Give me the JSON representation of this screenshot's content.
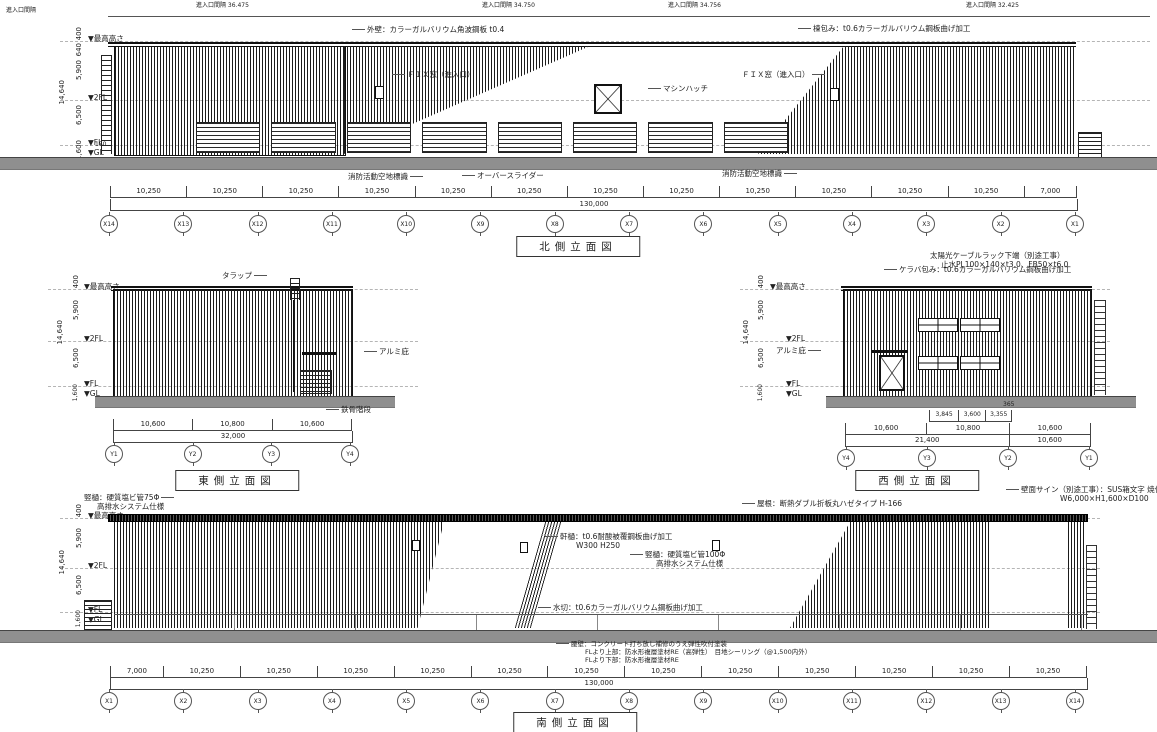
{
  "levels": {
    "names": [
      "▼最高高さ",
      "▼2FL",
      "▼FL",
      "▼GL"
    ],
    "vdims": [
      "400",
      "640",
      "5,900",
      "6,500",
      "1,600"
    ],
    "offset_fl": "150",
    "total": "14,640"
  },
  "north": {
    "title": "北側立面図",
    "entry_label": "進入口間隔",
    "top_dims": [
      "進入口間隔 36.475",
      "進入口間隔 34.750",
      "進入口間隔 34.756",
      "進入口間隔 32.425"
    ],
    "ann": {
      "wall": "外壁：カラーガルバリウム角波鋼板 t0.4",
      "ridge": "棟包み：t0.6カラーガルバリウム鋼板曲げ加工",
      "fix_left": "ＦＩＸ窓（進入口）",
      "fix_right": "ＦＩＸ窓（進入口）",
      "machine_hatch": "マシンハッチ",
      "fire_sign_left": "消防活動空地標識",
      "fire_sign_right": "消防活動空地標識",
      "overhead_slider": "オーバースライダー"
    },
    "dims": [
      {
        "label": "10,250",
        "w": 10250
      },
      {
        "label": "10,250",
        "w": 10250
      },
      {
        "label": "10,250",
        "w": 10250
      },
      {
        "label": "10,250",
        "w": 10250
      },
      {
        "label": "10,250",
        "w": 10250
      },
      {
        "label": "10,250",
        "w": 10250
      },
      {
        "label": "10,250",
        "w": 10250
      },
      {
        "label": "10,250",
        "w": 10250
      },
      {
        "label": "10,250",
        "w": 10250
      },
      {
        "label": "10,250",
        "w": 10250
      },
      {
        "label": "10,250",
        "w": 10250
      },
      {
        "label": "10,250",
        "w": 10250
      },
      {
        "label": "7,000",
        "w": 7000
      }
    ],
    "total": "130,000",
    "grids": [
      "X14",
      "X13",
      "X12",
      "X11",
      "X10",
      "X9",
      "X8",
      "X7",
      "X6",
      "X5",
      "X4",
      "X3",
      "X2",
      "X1"
    ]
  },
  "east": {
    "title": "東側立面図",
    "ann": {
      "trap": "タラップ",
      "awning": "アルミ庇",
      "stair": "鉄骨階段"
    },
    "dims": [
      {
        "label": "10,600",
        "w": 10600
      },
      {
        "label": "10,800",
        "w": 10800
      },
      {
        "label": "10,600",
        "w": 10600
      }
    ],
    "total": "32,000",
    "grids": [
      "Y1",
      "Y2",
      "Y3",
      "Y4"
    ]
  },
  "west": {
    "title": "西側立面図",
    "ann": {
      "kiraba": "ケラバ包み：t0.6カラーガルバリウム鋼板曲げ加工",
      "solar1": "太陽光ケーブルラック下端（別途工事）",
      "solar2": "止水PL100×140×t3.0、FB50×t6.0",
      "awning": "アルミ庇"
    },
    "sub_dims": [
      {
        "label": "3,845",
        "w": 3845
      },
      {
        "label": "3,600",
        "w": 3600
      },
      {
        "label": "3,355",
        "w": 3355
      }
    ],
    "sub_small": "365",
    "dims": [
      {
        "label": "10,600",
        "w": 10600
      },
      {
        "label": "10,800",
        "w": 10800
      },
      {
        "label": "10,600",
        "w": 10600
      }
    ],
    "dims2": [
      {
        "label": "21,400",
        "w": 21400
      },
      {
        "label": "10,600",
        "w": 10600
      }
    ],
    "grids": [
      "Y4",
      "Y3",
      "Y2",
      "Y1"
    ]
  },
  "south": {
    "title": "南側立面図",
    "ann": {
      "downpipe_left1": "竪樋：硬質塩ビ管75Φ",
      "downpipe_left2": "高排水システム仕様",
      "roof": "屋根：断熱ダブル折板丸ハゼタイプ H-166",
      "eaves1": "軒樋：t0.6耐酸被覆鋼板曲げ加工",
      "eaves2": "W300 H250",
      "downpipe1": "竪樋：硬質塩ビ管100Φ",
      "downpipe2": "高排水システム仕様",
      "flashing": "水切：t0.6カラーガルバリウム鋼板曲げ加工",
      "base1": "腰壁：コンクリート打ち放し補修のうえ弾性吹付塗装",
      "base2": "FLより上部：防水形複層塗材RE（高弾性）　目地シーリング（@1,500内外）",
      "base3": "FLより下部：防水形複層塗材RE",
      "sign1": "壁面サイン（別途工事）：SUS箱文字 焼付塗装",
      "sign2": "W6,000×H1,600×D100"
    },
    "dims": [
      {
        "label": "7,000",
        "w": 7000
      },
      {
        "label": "10,250",
        "w": 10250
      },
      {
        "label": "10,250",
        "w": 10250
      },
      {
        "label": "10,250",
        "w": 10250
      },
      {
        "label": "10,250",
        "w": 10250
      },
      {
        "label": "10,250",
        "w": 10250
      },
      {
        "label": "10,250",
        "w": 10250
      },
      {
        "label": "10,250",
        "w": 10250
      },
      {
        "label": "10,250",
        "w": 10250
      },
      {
        "label": "10,250",
        "w": 10250
      },
      {
        "label": "10,250",
        "w": 10250
      },
      {
        "label": "10,250",
        "w": 10250
      },
      {
        "label": "10,250",
        "w": 10250
      }
    ],
    "total": "130,000",
    "grids": [
      "X1",
      "X2",
      "X3",
      "X4",
      "X5",
      "X6",
      "X7",
      "X8",
      "X9",
      "X10",
      "X11",
      "X12",
      "X13",
      "X14"
    ]
  }
}
